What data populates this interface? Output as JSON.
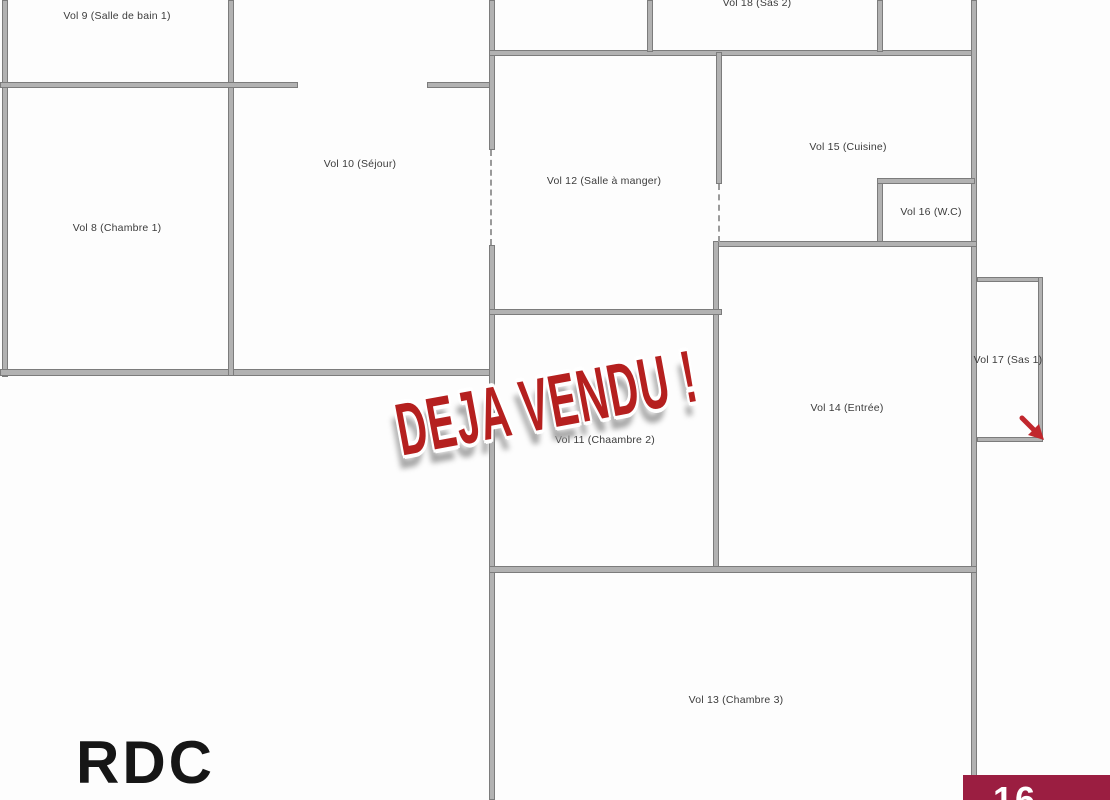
{
  "floor": {
    "title": "RDC"
  },
  "stamp": {
    "text": "DEJA VENDU !",
    "color": "#b5201f"
  },
  "rooms": {
    "vol8": {
      "label": "Vol 8 (Chambre 1)"
    },
    "vol9": {
      "label": "Vol 9 (Salle de bain 1)"
    },
    "vol10": {
      "label": "Vol 10 (Séjour)"
    },
    "vol11": {
      "label": "Vol 11 (Chaambre 2)"
    },
    "vol12": {
      "label": "Vol 12 (Salle à manger)"
    },
    "vol13": {
      "label": "Vol 13 (Chambre 3)"
    },
    "vol14": {
      "label": "Vol 14 (Entrée)"
    },
    "vol15": {
      "label": "Vol 15 (Cuisine)"
    },
    "vol16": {
      "label": "Vol 16 (W.C)"
    },
    "vol17": {
      "label": "Vol 17 (Sas 1)"
    },
    "vol18": {
      "label": "Vol 18 (Sas 2)"
    }
  },
  "logo": {
    "text": "16",
    "background": "#9b1e41"
  },
  "colors": {
    "wall_fill": "#b2b2b2",
    "wall_edge": "#7c7c7c",
    "stamp_red": "#b5201f",
    "arrow_red": "#c1272d",
    "background": "#fdfdfd"
  },
  "icons": {
    "entrance_arrow": "red-diagonal-arrow"
  }
}
